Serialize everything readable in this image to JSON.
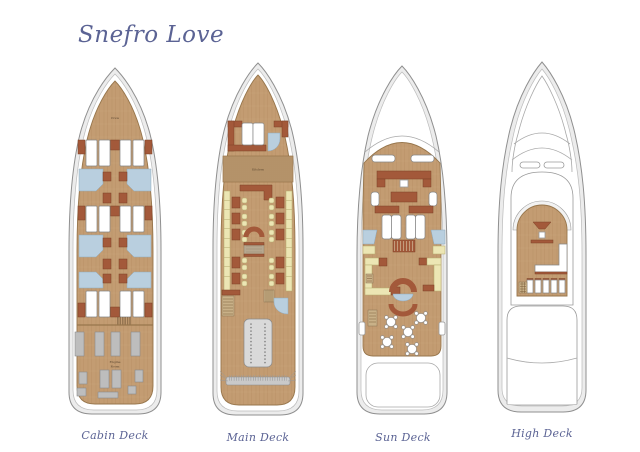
{
  "title": "Snefro Love",
  "deck_plans": [
    {
      "label": "Cabin Deck"
    },
    {
      "label": "Main Deck"
    },
    {
      "label": "Sun Deck"
    },
    {
      "label": "High Deck"
    }
  ],
  "room_labels": {
    "crew": "Crew",
    "kitchen": "Kitchen",
    "engine_line1": "Engine",
    "engine_line2": "Room"
  },
  "colors": {
    "title-text": "#5b6394",
    "wood": "#c39c72",
    "wood-edge": "#97764c",
    "hull": "#ececec",
    "hull-outline": "#8f8f8f",
    "bathroom-blue": "#b9cfdf",
    "furniture-brown": "#a3593a",
    "bench-cream": "#ece6b4",
    "machinery-gray": "#bdbdbd"
  }
}
